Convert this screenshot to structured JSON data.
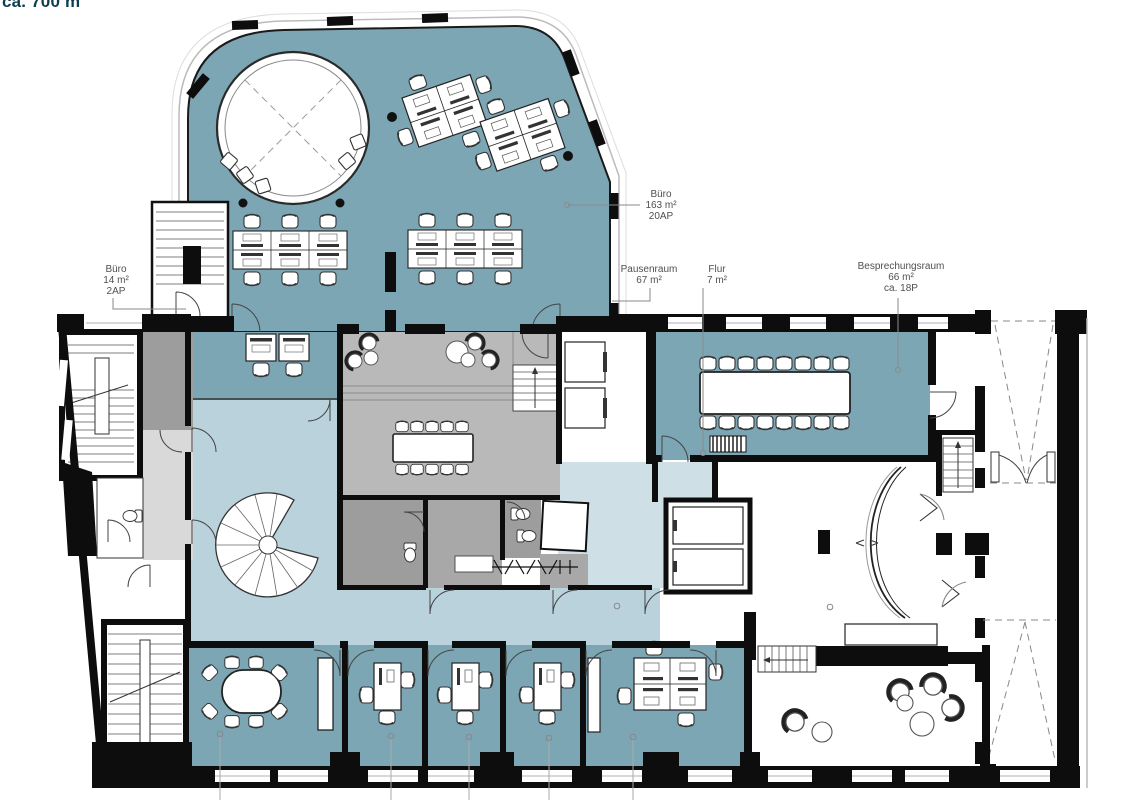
{
  "header": {
    "area_text": "ca. 700 m"
  },
  "colors": {
    "room_teal": "#7ca6b4",
    "corridor_blue": "#b9d2db",
    "light_blue": "#cfdfe6",
    "floor_gray": "#b9b9b9",
    "dark_gray": "#9d9d9d",
    "mid_gray": "#a8a8a8",
    "pale_gray": "#d9d9d9",
    "wall_black": "#0d0d0d",
    "heading_teal": "#0e3e50",
    "label_gray": "#4f4f4f"
  },
  "labels": {
    "buero_klein": {
      "line1": "Büro",
      "line2": "14 m²",
      "line3": "2AP"
    },
    "buero_gross": {
      "line1": "Büro",
      "line2": "163 m²",
      "line3": "20AP"
    },
    "pausenraum": {
      "line1": "Pausenraum",
      "line2": "67 m²"
    },
    "flur": {
      "line1": "Flur",
      "line2": "7 m²"
    },
    "besprechungsraum": {
      "line1": "Besprechungsraum",
      "line2": "66 m²",
      "line3": "ca. 18P"
    }
  }
}
